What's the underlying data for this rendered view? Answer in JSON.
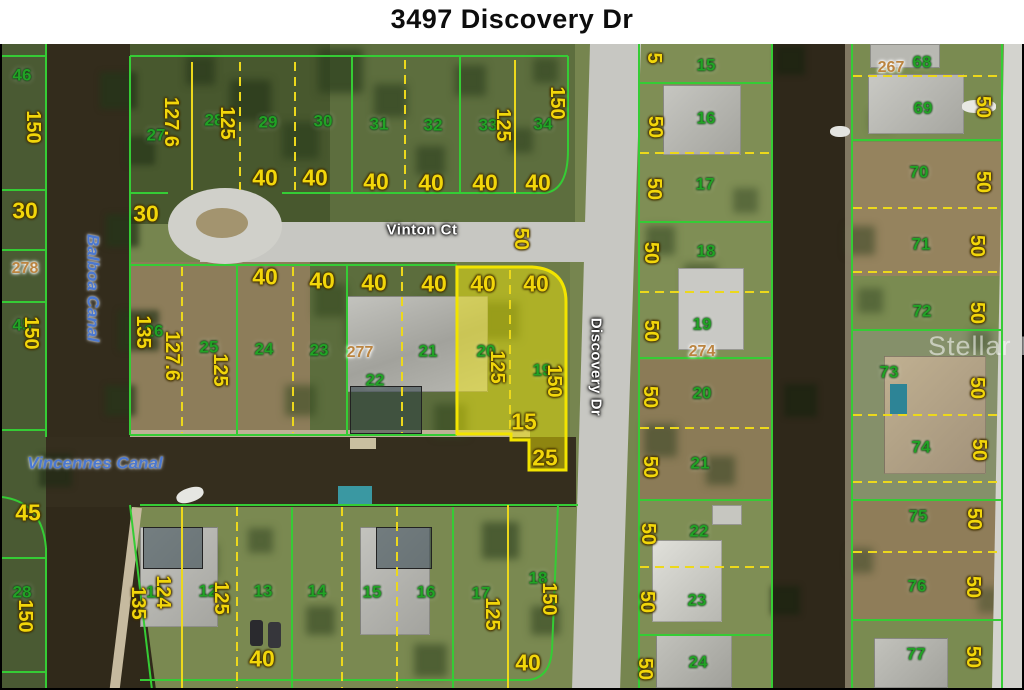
{
  "title": "3497 Discovery Dr",
  "watermark": "Stellar MLS",
  "subject_parcel": {
    "address": "3497 Discovery Dr",
    "highlighted_lot_numbers": [
      "20",
      "19"
    ]
  },
  "streets": {
    "vinton": "Vinton Ct",
    "discovery": "Discovery Dr"
  },
  "canals": {
    "balboa": "Balboa Canal",
    "vincennes": "Vincennes Canal"
  },
  "colors": {
    "lot_number_green": "#21a325",
    "dimension_yellow": "#f2d60a",
    "block_number_tan": "#bb8440",
    "boundary_green": "#35cc35",
    "boundary_yellow": "#ecd81c",
    "highlight_fill": "rgba(250,240,0,0.45)",
    "highlight_stroke": "#f2e400",
    "canal_label_blue": "#4b78d0",
    "water_dark": "#332c1c",
    "road_gray": "#c7c7c2"
  },
  "labels": [
    {
      "t": "46",
      "k": "lot",
      "x": 22,
      "y": 75
    },
    {
      "t": "27",
      "k": "lot",
      "x": 156,
      "y": 135
    },
    {
      "t": "28",
      "k": "lot",
      "x": 214,
      "y": 120
    },
    {
      "t": "29",
      "k": "lot",
      "x": 268,
      "y": 122
    },
    {
      "t": "30",
      "k": "lot",
      "x": 323,
      "y": 121
    },
    {
      "t": "31",
      "k": "lot",
      "x": 379,
      "y": 124
    },
    {
      "t": "32",
      "k": "lot",
      "x": 433,
      "y": 125
    },
    {
      "t": "33",
      "k": "lot",
      "x": 488,
      "y": 125
    },
    {
      "t": "34",
      "k": "lot",
      "x": 543,
      "y": 124
    },
    {
      "t": "15",
      "k": "lot",
      "x": 706,
      "y": 65
    },
    {
      "t": "16",
      "k": "lot",
      "x": 706,
      "y": 118
    },
    {
      "t": "17",
      "k": "lot",
      "x": 705,
      "y": 184
    },
    {
      "t": "18",
      "k": "lot",
      "x": 706,
      "y": 251
    },
    {
      "t": "19",
      "k": "lot",
      "x": 702,
      "y": 324
    },
    {
      "t": "20",
      "k": "lot",
      "x": 702,
      "y": 393
    },
    {
      "t": "21",
      "k": "lot",
      "x": 700,
      "y": 463
    },
    {
      "t": "22",
      "k": "lot",
      "x": 699,
      "y": 531
    },
    {
      "t": "23",
      "k": "lot",
      "x": 697,
      "y": 600
    },
    {
      "t": "24",
      "k": "lot",
      "x": 698,
      "y": 662
    },
    {
      "t": "68",
      "k": "lot",
      "x": 922,
      "y": 62
    },
    {
      "t": "69",
      "k": "lot",
      "x": 923,
      "y": 108
    },
    {
      "t": "70",
      "k": "lot",
      "x": 919,
      "y": 172
    },
    {
      "t": "71",
      "k": "lot",
      "x": 921,
      "y": 244
    },
    {
      "t": "72",
      "k": "lot",
      "x": 922,
      "y": 311
    },
    {
      "t": "73",
      "k": "lot",
      "x": 889,
      "y": 372
    },
    {
      "t": "74",
      "k": "lot",
      "x": 921,
      "y": 447
    },
    {
      "t": "75",
      "k": "lot",
      "x": 918,
      "y": 516
    },
    {
      "t": "76",
      "k": "lot",
      "x": 917,
      "y": 586
    },
    {
      "t": "77",
      "k": "lot",
      "x": 916,
      "y": 654
    },
    {
      "t": "26",
      "k": "lot",
      "x": 154,
      "y": 331
    },
    {
      "t": "25",
      "k": "lot",
      "x": 209,
      "y": 347
    },
    {
      "t": "24",
      "k": "lot",
      "x": 264,
      "y": 349
    },
    {
      "t": "23",
      "k": "lot",
      "x": 319,
      "y": 350
    },
    {
      "t": "22",
      "k": "lot",
      "x": 375,
      "y": 380
    },
    {
      "t": "21",
      "k": "lot",
      "x": 428,
      "y": 351
    },
    {
      "t": "20",
      "k": "lot",
      "x": 486,
      "y": 351
    },
    {
      "t": "19",
      "k": "lot",
      "x": 542,
      "y": 370
    },
    {
      "t": "45",
      "k": "lot",
      "x": 22,
      "y": 325
    },
    {
      "t": "28",
      "k": "lot",
      "x": 22,
      "y": 592
    },
    {
      "t": "11",
      "k": "lot",
      "x": 155,
      "y": 592
    },
    {
      "t": "12",
      "k": "lot",
      "x": 208,
      "y": 591
    },
    {
      "t": "13",
      "k": "lot",
      "x": 263,
      "y": 591
    },
    {
      "t": "14",
      "k": "lot",
      "x": 317,
      "y": 591
    },
    {
      "t": "15",
      "k": "lot",
      "x": 372,
      "y": 592
    },
    {
      "t": "16",
      "k": "lot",
      "x": 426,
      "y": 592
    },
    {
      "t": "17",
      "k": "lot",
      "x": 481,
      "y": 593
    },
    {
      "t": "18",
      "k": "lot",
      "x": 538,
      "y": 578
    },
    {
      "t": "278",
      "k": "block",
      "x": 25,
      "y": 269
    },
    {
      "t": "277",
      "k": "block",
      "x": 360,
      "y": 353
    },
    {
      "t": "274",
      "k": "block",
      "x": 702,
      "y": 352
    },
    {
      "t": "267",
      "k": "block",
      "x": 891,
      "y": 68
    },
    {
      "t": "150",
      "k": "dim",
      "r": 1,
      "x": 33,
      "y": 127
    },
    {
      "t": "30",
      "k": "dim",
      "x": 25,
      "y": 211
    },
    {
      "t": "30",
      "k": "dim",
      "x": 146,
      "y": 214
    },
    {
      "t": "127.6",
      "k": "dim",
      "r": 1,
      "x": 171,
      "y": 122
    },
    {
      "t": "125",
      "k": "dim",
      "r": 1,
      "x": 227,
      "y": 123
    },
    {
      "t": "40",
      "k": "dim",
      "x": 265,
      "y": 178
    },
    {
      "t": "40",
      "k": "dim",
      "x": 315,
      "y": 178
    },
    {
      "t": "40",
      "k": "dim",
      "x": 376,
      "y": 182
    },
    {
      "t": "40",
      "k": "dim",
      "x": 431,
      "y": 183
    },
    {
      "t": "40",
      "k": "dim",
      "x": 485,
      "y": 183
    },
    {
      "t": "40",
      "k": "dim",
      "x": 538,
      "y": 183
    },
    {
      "t": "125",
      "k": "dim",
      "r": 1,
      "x": 503,
      "y": 125
    },
    {
      "t": "150",
      "k": "dim",
      "r": 1,
      "x": 557,
      "y": 103
    },
    {
      "t": "50",
      "k": "dim",
      "r": 1,
      "x": 521,
      "y": 239
    },
    {
      "t": "5",
      "k": "dim",
      "r": 1,
      "x": 654,
      "y": 58
    },
    {
      "t": "50",
      "k": "dim",
      "r": 1,
      "x": 655,
      "y": 127
    },
    {
      "t": "50",
      "k": "dim",
      "r": 1,
      "x": 654,
      "y": 189
    },
    {
      "t": "50",
      "k": "dim",
      "r": 1,
      "x": 651,
      "y": 253
    },
    {
      "t": "50",
      "k": "dim",
      "r": 1,
      "x": 651,
      "y": 331
    },
    {
      "t": "50",
      "k": "dim",
      "r": 1,
      "x": 650,
      "y": 397
    },
    {
      "t": "50",
      "k": "dim",
      "r": 1,
      "x": 650,
      "y": 467
    },
    {
      "t": "50",
      "k": "dim",
      "r": 1,
      "x": 648,
      "y": 534
    },
    {
      "t": "50",
      "k": "dim",
      "r": 1,
      "x": 647,
      "y": 602
    },
    {
      "t": "50",
      "k": "dim",
      "r": 1,
      "x": 645,
      "y": 669
    },
    {
      "t": "50",
      "k": "dim",
      "r": 1,
      "x": 983,
      "y": 107
    },
    {
      "t": "50",
      "k": "dim",
      "r": 1,
      "x": 983,
      "y": 182
    },
    {
      "t": "50",
      "k": "dim",
      "r": 1,
      "x": 977,
      "y": 246
    },
    {
      "t": "50",
      "k": "dim",
      "r": 1,
      "x": 977,
      "y": 313
    },
    {
      "t": "50",
      "k": "dim",
      "r": 1,
      "x": 977,
      "y": 388
    },
    {
      "t": "50",
      "k": "dim",
      "r": 1,
      "x": 979,
      "y": 450
    },
    {
      "t": "50",
      "k": "dim",
      "r": 1,
      "x": 974,
      "y": 519
    },
    {
      "t": "50",
      "k": "dim",
      "r": 1,
      "x": 973,
      "y": 587
    },
    {
      "t": "50",
      "k": "dim",
      "r": 1,
      "x": 973,
      "y": 657
    },
    {
      "t": "40",
      "k": "dim",
      "x": 265,
      "y": 277
    },
    {
      "t": "135",
      "k": "dim",
      "r": 1,
      "x": 143,
      "y": 332
    },
    {
      "t": "127.6",
      "k": "dim",
      "r": 1,
      "x": 172,
      "y": 356
    },
    {
      "t": "125",
      "k": "dim",
      "r": 1,
      "x": 220,
      "y": 370
    },
    {
      "t": "40",
      "k": "dim",
      "x": 322,
      "y": 281
    },
    {
      "t": "40",
      "k": "dim",
      "x": 374,
      "y": 283
    },
    {
      "t": "40",
      "k": "dim",
      "x": 434,
      "y": 284
    },
    {
      "t": "40",
      "k": "dim",
      "x": 483,
      "y": 284
    },
    {
      "t": "40",
      "k": "dim",
      "x": 536,
      "y": 284
    },
    {
      "t": "125",
      "k": "dim",
      "r": 1,
      "x": 497,
      "y": 367
    },
    {
      "t": "150",
      "k": "dim",
      "r": 1,
      "x": 554,
      "y": 381
    },
    {
      "t": "15",
      "k": "dim",
      "x": 524,
      "y": 422
    },
    {
      "t": "25",
      "k": "dim",
      "x": 545,
      "y": 458
    },
    {
      "t": "45",
      "k": "dim",
      "x": 28,
      "y": 513
    },
    {
      "t": "150",
      "k": "dim",
      "r": 1,
      "x": 31,
      "y": 333
    },
    {
      "t": "150",
      "k": "dim",
      "r": 1,
      "x": 25,
      "y": 616
    },
    {
      "t": "135",
      "k": "dim",
      "r": 1,
      "x": 138,
      "y": 603
    },
    {
      "t": "124",
      "k": "dim",
      "r": 1,
      "x": 163,
      "y": 592
    },
    {
      "t": "125",
      "k": "dim",
      "r": 1,
      "x": 221,
      "y": 598
    },
    {
      "t": "125",
      "k": "dim",
      "r": 1,
      "x": 492,
      "y": 614
    },
    {
      "t": "150",
      "k": "dim",
      "r": 1,
      "x": 549,
      "y": 599
    },
    {
      "t": "40",
      "k": "dim",
      "x": 262,
      "y": 659
    },
    {
      "t": "40",
      "k": "dim",
      "x": 528,
      "y": 663
    },
    {
      "t": "Vinton Ct",
      "k": "street",
      "x": 422,
      "y": 230
    },
    {
      "t": "Discovery Dr",
      "k": "street",
      "r": 1,
      "x": 596,
      "y": 367
    },
    {
      "t": "Balboa Canal",
      "k": "canal",
      "r": 1,
      "x": 93,
      "y": 288
    },
    {
      "t": "Vincennes Canal",
      "k": "canal",
      "x": 95,
      "y": 463
    }
  ]
}
